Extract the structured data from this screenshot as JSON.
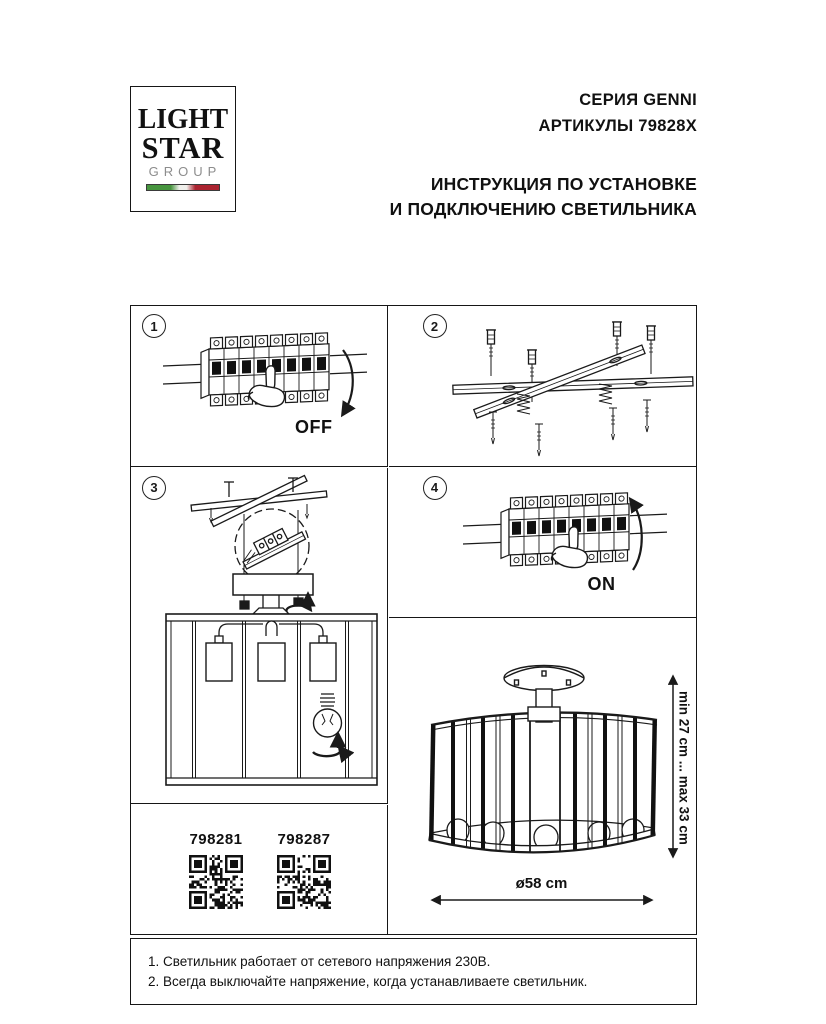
{
  "logo": {
    "line1": "LIGHT",
    "line2": "STAR",
    "line3": "GROUP",
    "flag_green": "#47953f",
    "flag_white": "#f0f0ec",
    "flag_red": "#ab2430"
  },
  "header": {
    "series": "СЕРИЯ GENNI",
    "articles": "АРТИКУЛЫ 79828X",
    "instruction_line1": "ИНСТРУКЦИЯ ПО УСТАНОВКЕ",
    "instruction_line2": "И ПОДКЛЮЧЕНИЮ СВЕТИЛЬНИКА"
  },
  "steps": [
    {
      "number": "1",
      "caption": "OFF"
    },
    {
      "number": "2",
      "caption": ""
    },
    {
      "number": "3",
      "caption": ""
    },
    {
      "number": "4",
      "caption": "ON"
    }
  ],
  "product_codes": [
    "798281",
    "798287"
  ],
  "dimensions": {
    "height_range": "min 27 cm ... max 33 cm",
    "diameter": "ø58 cm"
  },
  "notes": [
    "1. Светильник работает от сетевого напряжения 230В.",
    "2. Всегда выключайте напряжение, когда устанавливаете светильник."
  ],
  "line_color": "#1a1a1a"
}
